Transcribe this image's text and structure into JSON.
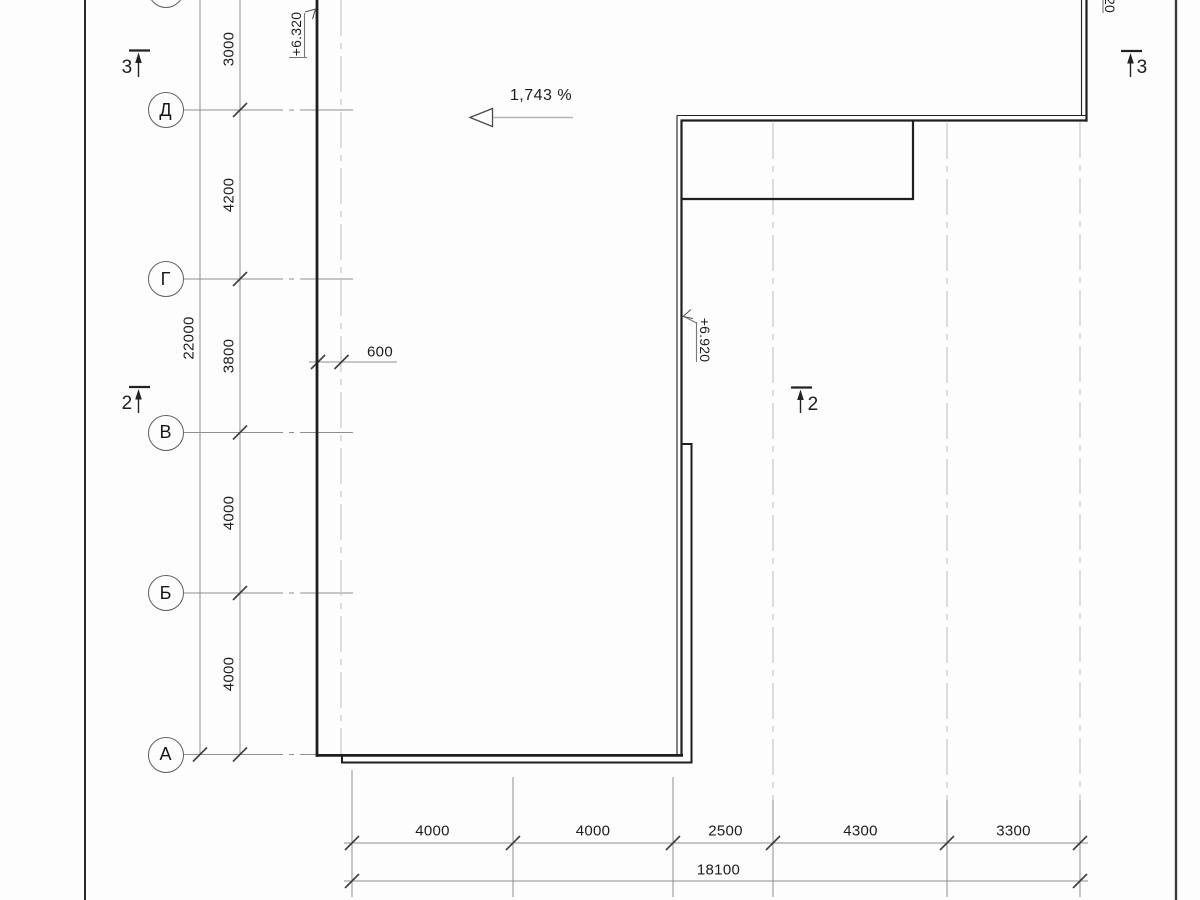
{
  "sheet": {
    "row_axes": [
      {
        "label": "Д"
      },
      {
        "label": "Г"
      },
      {
        "label": "В"
      },
      {
        "label": "Б"
      },
      {
        "label": "А"
      }
    ],
    "vertical_dim_chain": [
      "3000",
      "4200",
      "3800",
      "4000",
      "4000"
    ],
    "vertical_overall_dim": "22000",
    "wall_offset_dim": "600",
    "bottom_dim_chain": [
      "4000",
      "4000",
      "2500",
      "4300",
      "3300"
    ],
    "bottom_overall_dim": "18100",
    "slope": {
      "label": "1,743 %"
    },
    "elevation_marks": {
      "upper_left": "+6.320",
      "inner_wall": "+6.920",
      "top_right_partial": "020"
    },
    "section_markers": {
      "top_left": "3",
      "top_right": "3",
      "mid_left": "2",
      "mid_center": "2"
    }
  }
}
